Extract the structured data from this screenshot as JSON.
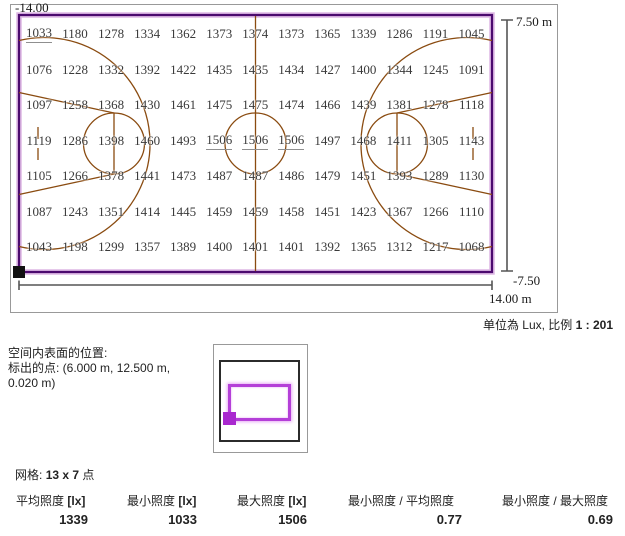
{
  "unit_scale": {
    "prefix": "单位為 Lux, 比例",
    "value": "1 : 201"
  },
  "dimensions": {
    "top_right": "7.50 m",
    "bottom_right_vertical": "-7.50",
    "bottom_left": "-14.00",
    "bottom_right_horizontal": "14.00 m"
  },
  "surface_position": {
    "line1": "空间内表面的位置:",
    "line2": "标出的点: (6.000 m, 12.500 m,",
    "line3": "0.020 m)"
  },
  "grid_size": {
    "prefix": "网格:",
    "value": "13 x 7",
    "suffix": "点"
  },
  "stats": [
    {
      "label": "平均照度",
      "unit": "[lx]",
      "value": "1339"
    },
    {
      "label": "最小照度",
      "unit": "[lx]",
      "value": "1033"
    },
    {
      "label": "最大照度",
      "unit": "[lx]",
      "value": "1506"
    },
    {
      "label": "最小照度 / 平均照度",
      "unit": "",
      "value": "0.77"
    },
    {
      "label": "最小照度 / 最大照度",
      "unit": "",
      "value": "0.69"
    }
  ],
  "colors": {
    "surface_outline": "#4b0a6e",
    "surface_glow": "#ddb7e4",
    "court_lines": "#8a4b10",
    "dimension_lines": "#555555",
    "value_text": "#3a3a3a",
    "inset_surface": "#b43fd8"
  },
  "chart_data": {
    "type": "heatmap",
    "description": "Illuminance value chart (lux) on basketball court calculation surface",
    "unit": "Lux",
    "scale": "1 : 201",
    "grid_points": "13 x 7",
    "x_range_m": [
      -14.0,
      14.0
    ],
    "y_range_m": [
      -7.5,
      7.5
    ],
    "values": [
      [
        1033,
        1180,
        1278,
        1334,
        1362,
        1373,
        1374,
        1373,
        1365,
        1339,
        1286,
        1191,
        1045
      ],
      [
        1076,
        1228,
        1332,
        1392,
        1422,
        1435,
        1435,
        1434,
        1427,
        1400,
        1344,
        1245,
        1091
      ],
      [
        1097,
        1258,
        1368,
        1430,
        1461,
        1475,
        1475,
        1474,
        1466,
        1439,
        1381,
        1278,
        1118
      ],
      [
        1119,
        1286,
        1398,
        1460,
        1493,
        1506,
        1506,
        1506,
        1497,
        1468,
        1411,
        1305,
        1143
      ],
      [
        1105,
        1266,
        1378,
        1441,
        1473,
        1487,
        1487,
        1486,
        1479,
        1451,
        1393,
        1289,
        1130
      ],
      [
        1087,
        1243,
        1351,
        1414,
        1445,
        1459,
        1459,
        1458,
        1451,
        1423,
        1367,
        1266,
        1110
      ],
      [
        1043,
        1198,
        1299,
        1357,
        1389,
        1400,
        1401,
        1401,
        1392,
        1365,
        1312,
        1217,
        1068
      ]
    ],
    "stats": {
      "avg": 1339,
      "min": 1033,
      "max": 1506,
      "min_over_avg": 0.77,
      "min_over_max": 0.69
    }
  }
}
